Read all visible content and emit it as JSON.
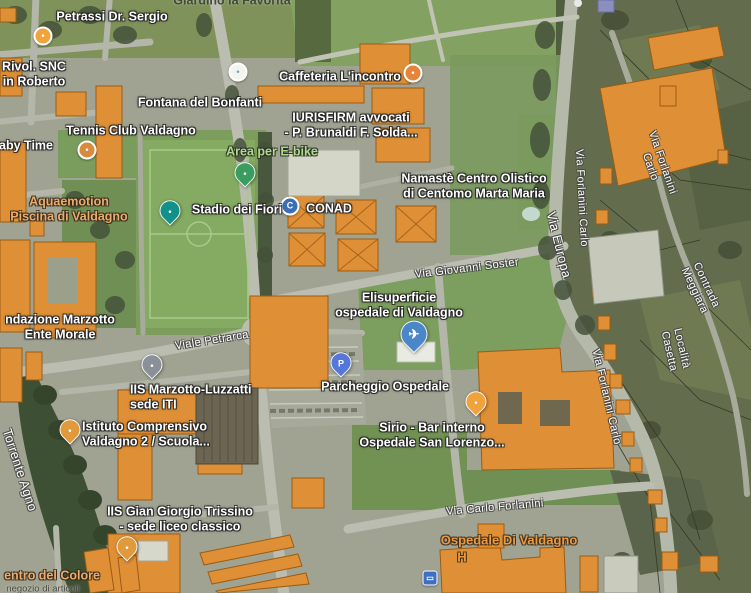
{
  "map": {
    "view_type": "satellite-hybrid",
    "colors": {
      "building_orange": "#df8f35",
      "building_outline": "#9c5c12",
      "road": "#babdb0",
      "field_green": "#84ab61",
      "woodland": "#636c4c",
      "river_trees": "#3e5034",
      "label_white": "#ffffff",
      "label_green": "#aed98f",
      "label_poi_orange": "#ecab6e",
      "label_hospital": "#ed9a3f"
    },
    "labels": [
      {
        "id": "label-giardino-la-favorita",
        "text": "Giardino la Favorita",
        "x": 232,
        "y": 1,
        "rot": 0,
        "cls": "lbl-dark",
        "interactable": true
      },
      {
        "id": "label-petrassi-dr-sergio",
        "text": "Petrassi Dr. Sergio",
        "x": 112,
        "y": 17,
        "rot": 0,
        "cls": "lbl-white",
        "interactable": true
      },
      {
        "id": "label-rivol-snc",
        "text": "Rivol. SNC\nin Roberto",
        "x": 34,
        "y": 74,
        "rot": 0,
        "cls": "lbl-white",
        "interactable": true
      },
      {
        "id": "label-caffeteria-lincontro",
        "text": "Caffeteria L'incontro",
        "x": 340,
        "y": 77,
        "rot": 0,
        "cls": "lbl-white",
        "interactable": true
      },
      {
        "id": "label-fontana-del-bonfanti",
        "text": "Fontana del Bonfanti",
        "x": 200,
        "y": 103,
        "rot": 0,
        "cls": "lbl-white",
        "interactable": true
      },
      {
        "id": "label-iurisfirm",
        "text": "IURISFIRM avvocati\n- P. Brunaldi F. Solda...",
        "x": 351,
        "y": 125,
        "rot": 0,
        "cls": "lbl-white",
        "interactable": true
      },
      {
        "id": "label-tennis-club-valdagno",
        "text": "Tennis Club Valdagno",
        "x": 131,
        "y": 131,
        "rot": 0,
        "cls": "lbl-white",
        "interactable": true
      },
      {
        "id": "label-baby-time",
        "text": "aby Time",
        "x": 26,
        "y": 146,
        "rot": 0,
        "cls": "lbl-white",
        "interactable": true
      },
      {
        "id": "label-area-per-e-bike",
        "text": "Area per E-bike",
        "x": 272,
        "y": 152,
        "rot": 0,
        "cls": "lbl-green",
        "interactable": true
      },
      {
        "id": "label-aquaemotion",
        "text": "Aquaemotion\nPiscina di Valdagno",
        "x": 69,
        "y": 209,
        "rot": 0,
        "cls": "lbl-poi-orange",
        "interactable": true
      },
      {
        "id": "label-stadio-dei-fiori",
        "text": "Stadio dei Fiori",
        "x": 237,
        "y": 210,
        "rot": 0,
        "cls": "lbl-white",
        "interactable": true
      },
      {
        "id": "label-conad",
        "text": "CONAD",
        "x": 329,
        "y": 209,
        "rot": 0,
        "cls": "lbl-white",
        "interactable": true
      },
      {
        "id": "label-namaste",
        "text": "Namastè Centro Olistico\ndi Centomo Marta Maria",
        "x": 474,
        "y": 186,
        "rot": 0,
        "cls": "lbl-white",
        "interactable": true
      },
      {
        "id": "label-via-europa",
        "text": "Via Europa",
        "x": 559,
        "y": 245,
        "rot": 76,
        "cls": "lbl-road lbl-road-big",
        "interactable": false
      },
      {
        "id": "label-via-forlanini-carlo-1",
        "text": "Via Forlanini Carlo",
        "x": 581,
        "y": 198,
        "rot": 87,
        "cls": "lbl-road",
        "interactable": false
      },
      {
        "id": "label-via-forlanini-carlo-2",
        "text": "Via Forlanini Carlo",
        "x": 656,
        "y": 165,
        "rot": 71,
        "cls": "lbl-road",
        "interactable": false
      },
      {
        "id": "label-via-forlanini-carlo-3",
        "text": "Via Forlanini Carlo",
        "x": 606,
        "y": 397,
        "rot": 77,
        "cls": "lbl-road",
        "interactable": false
      },
      {
        "id": "label-contrada-meggiara",
        "text": "Contrada Meggiara",
        "x": 700,
        "y": 288,
        "rot": 65,
        "cls": "lbl-road",
        "interactable": false
      },
      {
        "id": "label-localita-casetta",
        "text": "Località Casetta",
        "x": 675,
        "y": 350,
        "rot": 77,
        "cls": "lbl-road",
        "interactable": false
      },
      {
        "id": "label-via-giovanni-soster",
        "text": "Via Giovanni Soster",
        "x": 467,
        "y": 269,
        "rot": -7,
        "cls": "lbl-road",
        "interactable": false
      },
      {
        "id": "label-fondazione-marzotto",
        "text": "ndazione Marzotto\nEnte Morale",
        "x": 60,
        "y": 327,
        "rot": 0,
        "cls": "lbl-white",
        "interactable": true
      },
      {
        "id": "label-elisuperficie",
        "text": "Elisuperficie\nospedale di Valdagno",
        "x": 399,
        "y": 305,
        "rot": 0,
        "cls": "lbl-white",
        "interactable": true
      },
      {
        "id": "label-viale-petrarca",
        "text": "Viale Petrarca",
        "x": 212,
        "y": 341,
        "rot": -9,
        "cls": "lbl-road",
        "interactable": false
      },
      {
        "id": "label-iis-marzotto-luzzatti",
        "text": "IIS Marzotto-Luzzatti\nsede ITI",
        "x": 130,
        "y": 397,
        "rot": 0,
        "cls": "lbl-white",
        "align": "left",
        "interactable": true
      },
      {
        "id": "label-parcheggio-ospedale",
        "text": "Parcheggio Ospedale",
        "x": 385,
        "y": 387,
        "rot": 0,
        "cls": "lbl-white",
        "interactable": true
      },
      {
        "id": "label-istituto-comprensivo",
        "text": "Istituto Comprensivo\nValdagno 2 / Scuola...",
        "x": 82,
        "y": 434,
        "rot": 0,
        "cls": "lbl-white",
        "align": "left",
        "interactable": true
      },
      {
        "id": "label-sirio-bar",
        "text": "Sirio - Bar interno\nOspedale San Lorenzo...",
        "x": 432,
        "y": 435,
        "rot": 0,
        "cls": "lbl-white",
        "interactable": true
      },
      {
        "id": "label-torrente-agno",
        "text": "Torrente Agno",
        "x": 20,
        "y": 470,
        "rot": 72,
        "cls": "lbl-road lbl-road-big",
        "interactable": false
      },
      {
        "id": "label-iis-gian-giorgio-trissino",
        "text": "IIS Gian Giorgio Trissino\n- sede liceo classico",
        "x": 180,
        "y": 519,
        "rot": 0,
        "cls": "lbl-white",
        "interactable": true
      },
      {
        "id": "label-via-carlo-forlanini",
        "text": "Via Carlo Forlanini",
        "x": 495,
        "y": 508,
        "rot": -5,
        "cls": "lbl-road",
        "interactable": false
      },
      {
        "id": "label-ospedale-di-valdagno",
        "text": "Ospedale Di Valdagno",
        "x": 509,
        "y": 540,
        "rot": 0,
        "cls": "lbl-hosp",
        "interactable": true
      },
      {
        "id": "label-hospital-h",
        "text": "H",
        "x": 462,
        "y": 557,
        "rot": 0,
        "cls": "lbl-hosp",
        "interactable": true
      },
      {
        "id": "label-centro-del-colore",
        "text": "entro del Colore",
        "x": 52,
        "y": 576,
        "rot": 0,
        "cls": "lbl-poi-orange",
        "interactable": true
      },
      {
        "id": "label-negozio-di-articoli",
        "text": "negozio di articoli",
        "x": 43,
        "y": 589,
        "rot": 0,
        "cls": "lbl-dark-sm",
        "interactable": false
      }
    ],
    "markers": [
      {
        "id": "petrassi-poi-icon",
        "kind": "dot",
        "x": 43,
        "y": 36,
        "color": "#f2a33a",
        "glyph": "•"
      },
      {
        "id": "fountain-icon",
        "kind": "dot",
        "x": 238,
        "y": 72,
        "color": "#f2f4ee",
        "glyph": "•",
        "glyph_color": "#6aa5c8"
      },
      {
        "id": "cafe-icon",
        "kind": "dot",
        "x": 413,
        "y": 73,
        "color": "#e8833a",
        "glyph": "•"
      },
      {
        "id": "tennis-poi-icon",
        "kind": "dot",
        "x": 87,
        "y": 150,
        "color": "#d98a3e",
        "glyph": "•"
      },
      {
        "id": "ebike-pin-icon",
        "kind": "pin",
        "x": 245,
        "y": 182,
        "color": "#3a9c5f",
        "glyph": "•"
      },
      {
        "id": "stadium-pin-icon",
        "kind": "pin",
        "x": 170,
        "y": 220,
        "color": "#12918b",
        "glyph": "•"
      },
      {
        "id": "conad-logo-icon",
        "kind": "dot",
        "x": 290,
        "y": 206,
        "color": "#3b6fb5",
        "glyph": "C"
      },
      {
        "id": "helipad-pin-icon",
        "kind": "pin",
        "x": 414,
        "y": 346,
        "color": "#4a86c8",
        "glyph": "✈",
        "big": true
      },
      {
        "id": "parking-pin-icon",
        "kind": "pin",
        "x": 341,
        "y": 372,
        "color": "#5577d9",
        "glyph": "P"
      },
      {
        "id": "school-pin-marzotto-icon",
        "kind": "pin",
        "x": 152,
        "y": 374,
        "color": "#8a8f98",
        "glyph": "•"
      },
      {
        "id": "school-pin-istituto-icon",
        "kind": "pin",
        "x": 70,
        "y": 439,
        "color": "#e09a3c",
        "glyph": "•"
      },
      {
        "id": "bar-pin-sirio-icon",
        "kind": "pin",
        "x": 476,
        "y": 411,
        "color": "#f0a23c",
        "glyph": "•"
      },
      {
        "id": "school-pin-trissino-icon",
        "kind": "pin",
        "x": 127,
        "y": 556,
        "color": "#e09a3c",
        "glyph": "•"
      },
      {
        "id": "bus-stop-icon",
        "kind": "sq",
        "x": 430,
        "y": 578,
        "color": "#3f6fc4",
        "glyph": "▭"
      }
    ]
  }
}
